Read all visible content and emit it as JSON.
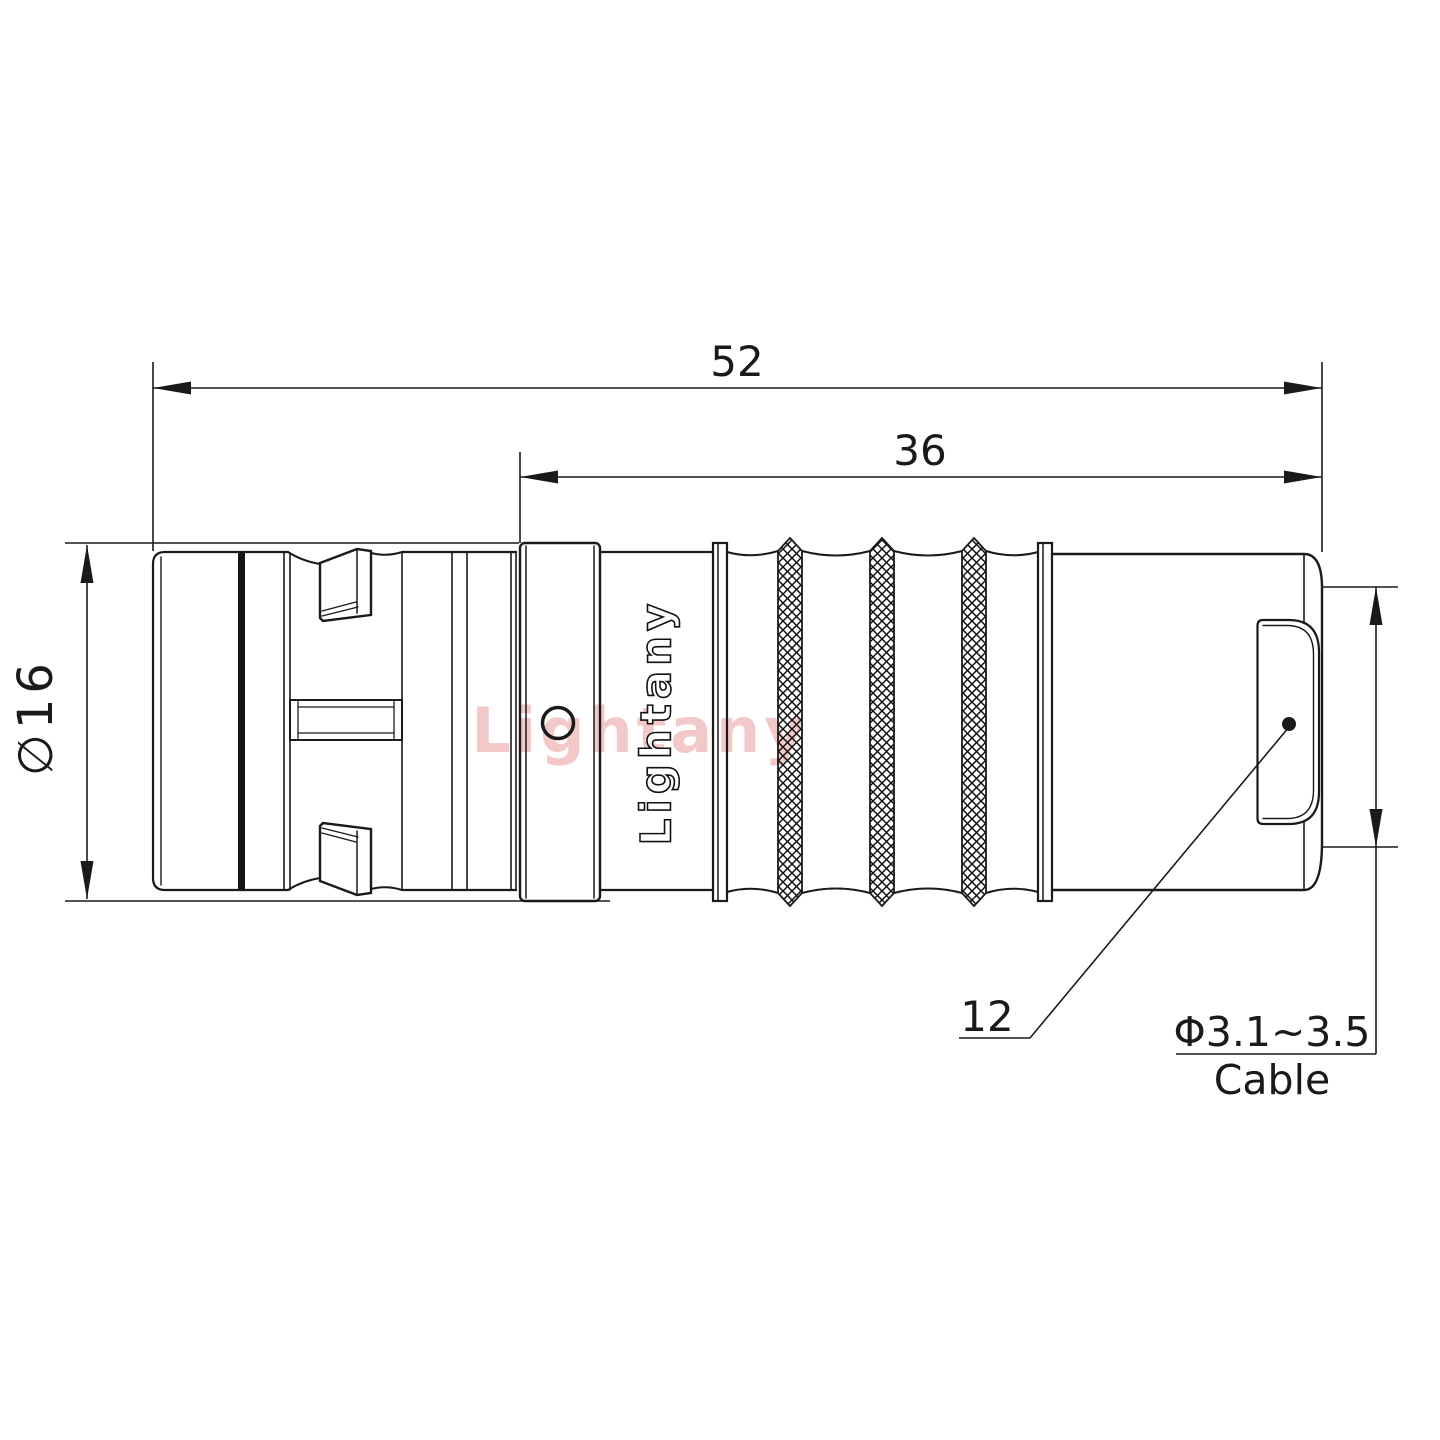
{
  "drawing": {
    "dimensions": {
      "total_length": "52",
      "rear_section_length": "36",
      "shell_diameter": "∅16",
      "end_face_diameter": "12",
      "cable_range": "Φ3.1~3.5",
      "cable_label": "Cable"
    },
    "branding": {
      "logo": "Lightany",
      "watermark": "Lightany"
    },
    "colors": {
      "line": "#1a1a1a",
      "watermark": "#dd5c5c"
    }
  }
}
